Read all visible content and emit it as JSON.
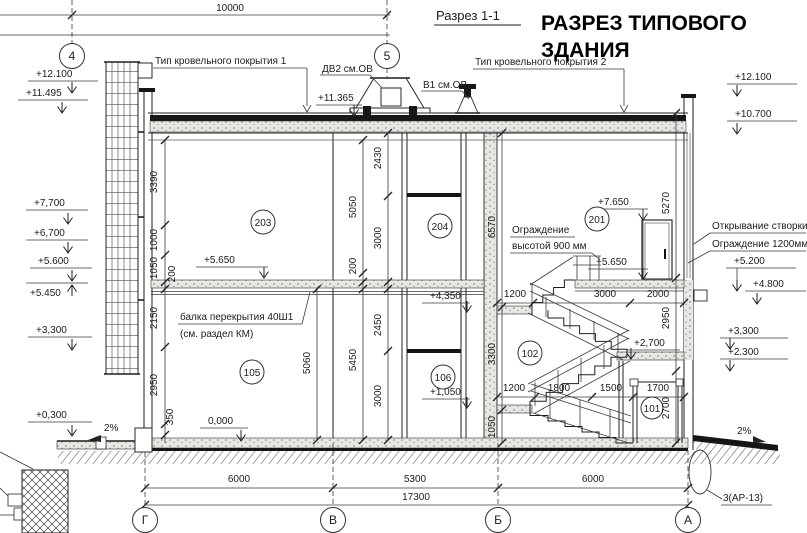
{
  "header": {
    "section_label": "Разрез 1-1",
    "title_line1": "РАЗРЕЗ ТИПОВОГО",
    "title_line2": "ЗДАНИЯ"
  },
  "axes": {
    "top": [
      {
        "label": "4"
      },
      {
        "label": "5"
      }
    ],
    "bottom": [
      {
        "label": "Г"
      },
      {
        "label": "В"
      },
      {
        "label": "Б"
      },
      {
        "label": "А"
      }
    ]
  },
  "dimensions": {
    "top": "10000",
    "bottom": [
      "6000",
      "5300",
      "6000",
      "17300"
    ],
    "left_chain": [
      "3390",
      "1000",
      "1050",
      "200",
      "2150",
      "2950",
      "350"
    ],
    "mid_chain_a": [
      "5050",
      "200",
      "5450",
      "5060"
    ],
    "mid_chain_b": [
      "2430",
      "3000",
      "2450",
      "3000"
    ],
    "stair_chain": [
      "6570",
      "3300",
      "1050"
    ],
    "right_chain": [
      "5270",
      "2950",
      "2700"
    ],
    "floor2_chain": [
      "1200",
      "3000",
      "2000"
    ],
    "floor1_chain": [
      "1200",
      "1800",
      "1500",
      "1700"
    ]
  },
  "elevations": {
    "left": [
      "+12.100",
      "+11.495",
      "+7,700",
      "+6,700",
      "+5.600",
      "+5.450",
      "+3,300",
      "+0,300"
    ],
    "right": [
      "+12.100",
      "+10.700",
      "+5.200",
      "+4.800",
      "+3,300",
      "+2.300"
    ],
    "inner": [
      "+11.365",
      "+5.650",
      "+7.650",
      "+5.650",
      "+4,350",
      "+1,050",
      "+2,700",
      "0,000"
    ]
  },
  "rooms": [
    {
      "number": "203"
    },
    {
      "number": "204"
    },
    {
      "number": "201"
    },
    {
      "number": "105"
    },
    {
      "number": "106"
    },
    {
      "number": "102"
    },
    {
      "number": "101"
    }
  ],
  "notes": {
    "roof_type_1": "Тип кровельного покрытия 1",
    "roof_type_2": "Тип кровельного покрытия 2",
    "vent_dv2": "ДВ2 см.ОВ",
    "vent_v1": "В1 см.ОВ",
    "beam_line1": "балка перекрытия 40Ш1",
    "beam_line2": "(см. раздел КМ)",
    "railing_line1": "Ограждение",
    "railing_line2": "высотой 900 мм",
    "opening_note": "Открывание створки",
    "railing2_note": "Ограждение 1200мм",
    "detail_ref": "3(АР-13)",
    "slope_left": "2%",
    "slope_right": "2%"
  }
}
